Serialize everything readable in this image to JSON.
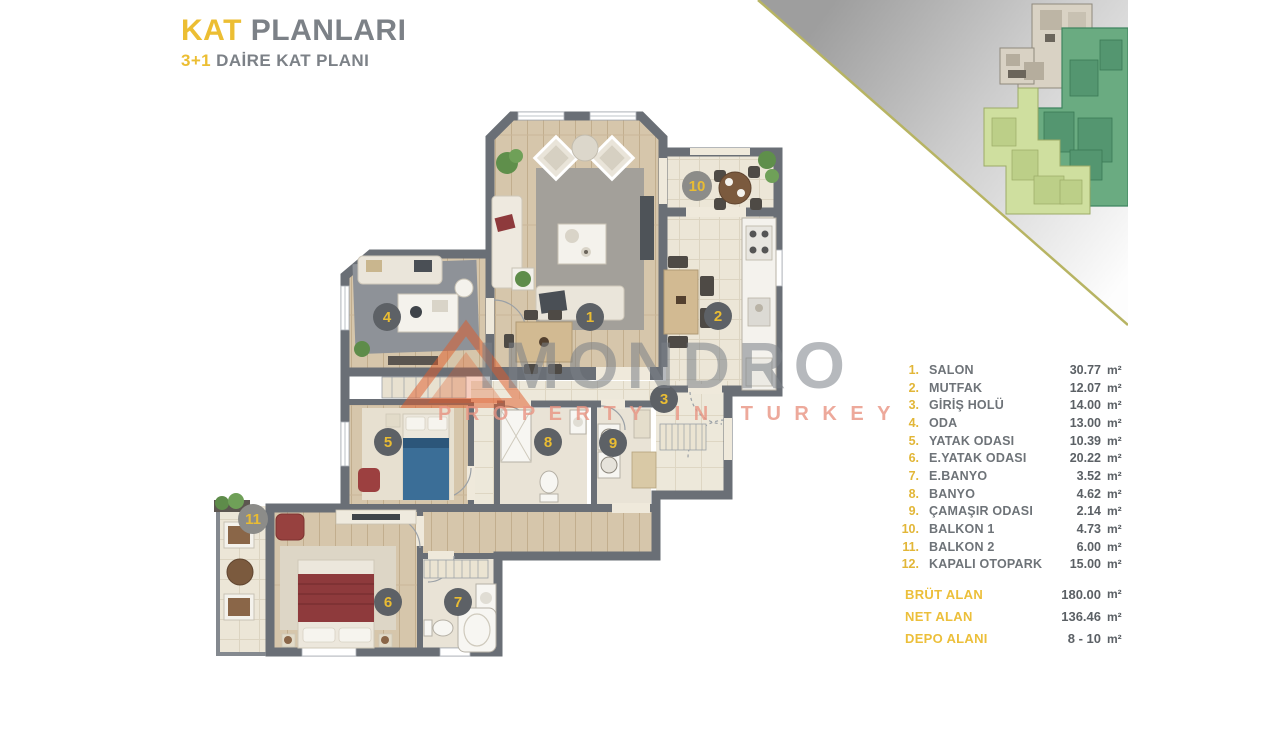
{
  "header": {
    "title_accent": "KAT",
    "title_rest": "PLANLARI",
    "subtitle_accent": "3+1",
    "subtitle_rest": "DAİRE KAT PLANI"
  },
  "watermark": {
    "brand": "IMONDRO",
    "tagline": "PROPERTY IN TURKEY"
  },
  "legend": {
    "unit": "m²",
    "rooms": [
      {
        "num": "1.",
        "label": "SALON",
        "area": "30.77"
      },
      {
        "num": "2.",
        "label": "MUTFAK",
        "area": "12.07"
      },
      {
        "num": "3.",
        "label": "GİRİŞ HOLÜ",
        "area": "14.00"
      },
      {
        "num": "4.",
        "label": "ODA",
        "area": "13.00"
      },
      {
        "num": "5.",
        "label": "YATAK ODASI",
        "area": "10.39"
      },
      {
        "num": "6.",
        "label": "E.YATAK ODASI",
        "area": "20.22"
      },
      {
        "num": "7.",
        "label": "E.BANYO",
        "area": "3.52"
      },
      {
        "num": "8.",
        "label": "BANYO",
        "area": "4.62"
      },
      {
        "num": "9.",
        "label": "ÇAMAŞIR ODASI",
        "area": "2.14"
      },
      {
        "num": "10.",
        "label": "BALKON 1",
        "area": "4.73"
      },
      {
        "num": "11.",
        "label": "BALKON 2",
        "area": "6.00"
      },
      {
        "num": "12.",
        "label": "KAPALI OTOPARK",
        "area": "15.00"
      }
    ],
    "totals": [
      {
        "label": "BRÜT ALAN",
        "value": "180.00"
      },
      {
        "label": "NET ALAN",
        "value": "136.46"
      },
      {
        "label": "DEPO ALANI",
        "value": "8 - 10"
      }
    ]
  },
  "plan": {
    "markers": [
      "1",
      "2",
      "3",
      "4",
      "5",
      "6",
      "7",
      "8",
      "9",
      "10",
      "11"
    ]
  },
  "colors": {
    "accent": "#e8bc38",
    "wall": "#6a6f76",
    "wood": "#d6c6ab",
    "tile": "#ece6d7",
    "green_dark": "#6aab81",
    "green_light": "#cfdf9f"
  }
}
